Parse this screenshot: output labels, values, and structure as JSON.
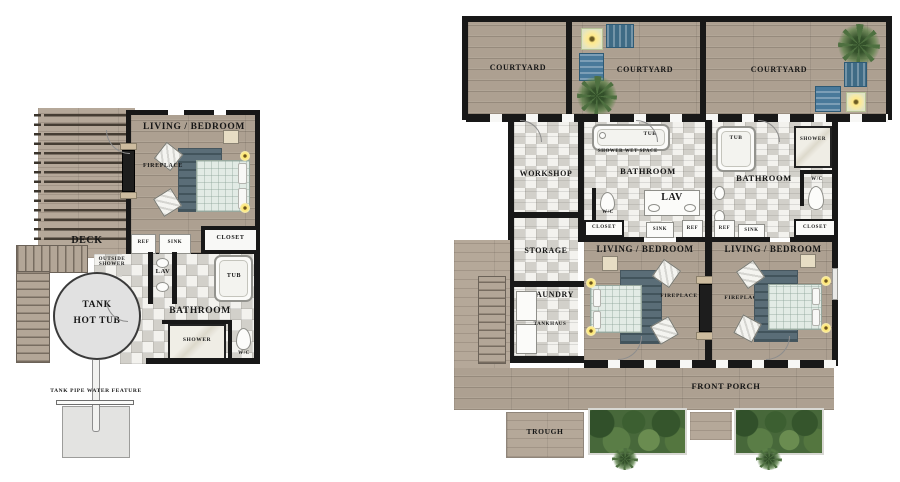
{
  "labels": {
    "living_bedroom": "LIVING / BEDROOM",
    "fireplace": "FIREPLACE",
    "deck": "DECK",
    "ref": "REF",
    "sink": "SINK",
    "closet": "CLOSET",
    "outside_shower": "OUTSIDE SHOWER",
    "lav": "LAV",
    "tub": "TUB",
    "bathroom": "BATHROOM",
    "shower": "SHOWER",
    "wc": "W/C",
    "tank": "TANK",
    "hot_tub": "HOT TUB",
    "water_feature": "TANK PIPE WATER FEATURE",
    "courtyard": "COURTYARD",
    "workshop": "WORKSHOP",
    "storage": "STORAGE",
    "laundry": "LAUNDRY",
    "tankhaus": "TANKHAUS",
    "shower_wet_space": "SHOWER WET SPACE",
    "front_porch": "FRONT PORCH",
    "trough": "TROUGH"
  },
  "colors": {
    "wall": "#181818",
    "wood": "#ada091",
    "tile": "#f3f2ee",
    "rug": "#5a6d77",
    "bed": "#e2ebe5",
    "furniture_blue": "#49799a",
    "fire_glow": "#ffe98a",
    "plant_green": "#47683a",
    "tank_gray": "#e1e1e1"
  }
}
